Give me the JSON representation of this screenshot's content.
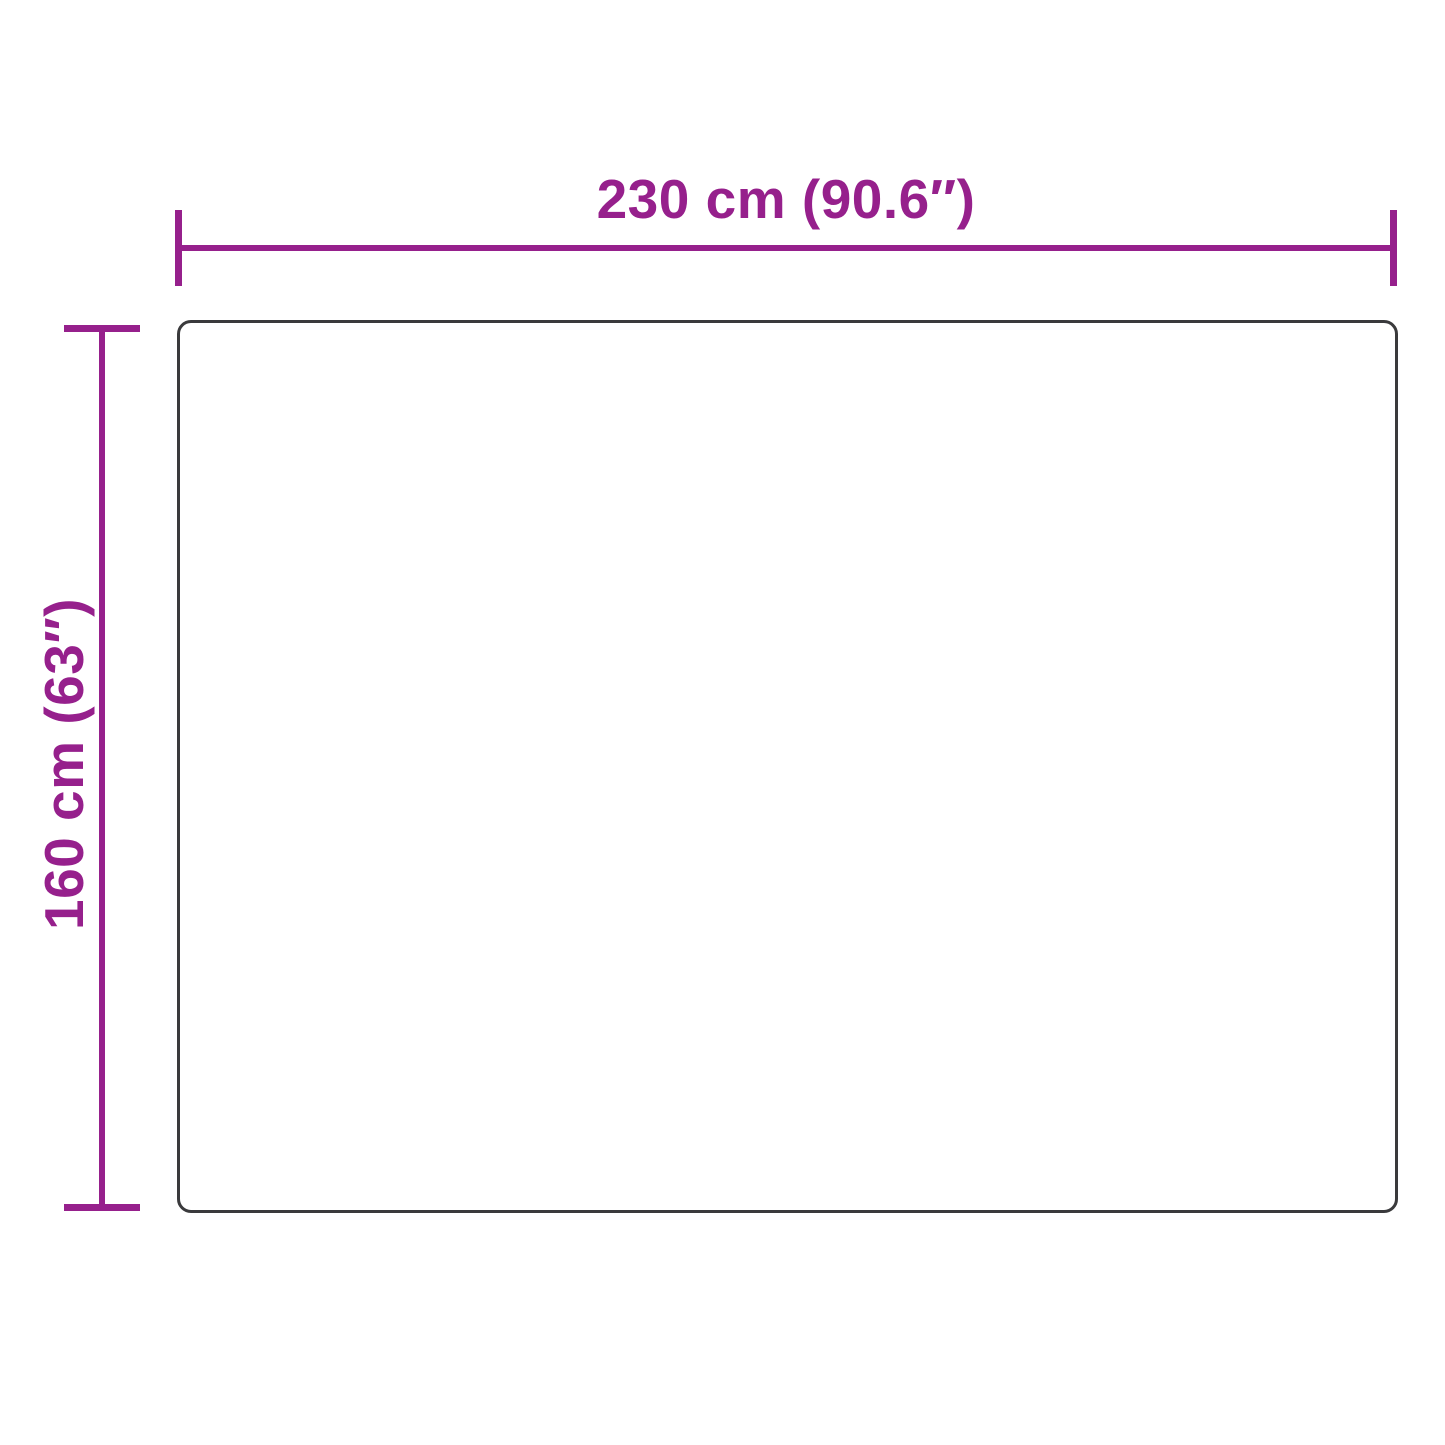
{
  "diagram": {
    "type": "product-dimensions",
    "width_label": "230 cm (90.6″)",
    "height_label": "160 cm (63″)",
    "width": {
      "cm": 230,
      "inches": 90.6
    },
    "height": {
      "cm": 160,
      "inches": 63
    }
  },
  "colors": {
    "dimension": "#96208C",
    "outline": "#3A3A3C",
    "background": "#FFFFFF"
  }
}
